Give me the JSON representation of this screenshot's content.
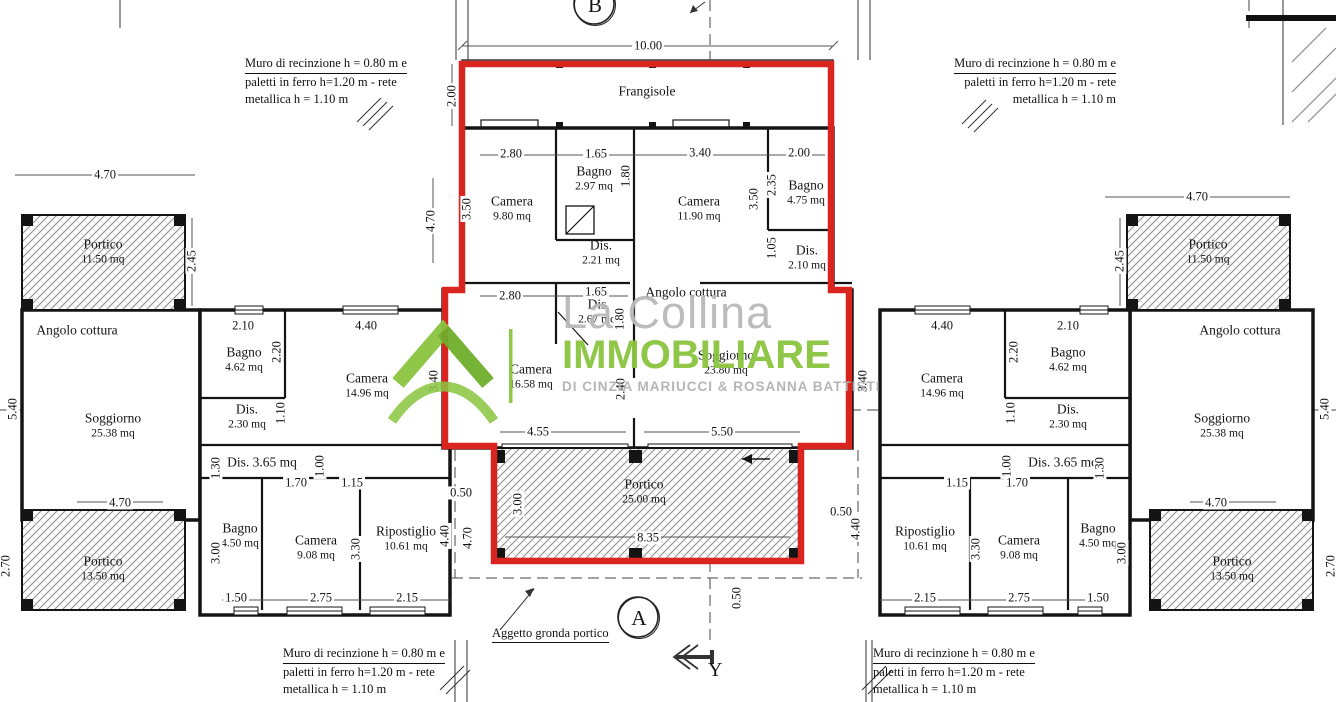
{
  "watermark": {
    "line1": "La Collina",
    "line2": "IMMOBILIARE",
    "line3": "DI CINZIA MARIUCCI & ROSANNA BATTISTI"
  },
  "markers": {
    "section_b": "B",
    "section_a": "A",
    "axis_y": "Y"
  },
  "callout_aggetto": "Aggetto gronda portico",
  "fence_note": {
    "line1": "Muro di recinzione h = 0.80 m e",
    "line2": "paletti in ferro h=1.20 m - rete",
    "line3": "metallica h = 1.10 m"
  },
  "colors": {
    "highlight_red": "#da2420",
    "brand_green": "#8bc53f",
    "hatch_gray": "#8f8f8f"
  },
  "rooms": [
    {
      "name": "Portico",
      "area": "11.50 mq",
      "x": 103,
      "y": 252
    },
    {
      "name": "Angolo cottura",
      "area": "",
      "x": 77,
      "y": 331
    },
    {
      "name": "Soggiorno",
      "area": "25.38 mq",
      "x": 113,
      "y": 426
    },
    {
      "name": "Bagno",
      "area": "4.62 mq",
      "x": 244,
      "y": 360
    },
    {
      "name": "Camera",
      "area": "14.96 mq",
      "x": 367,
      "y": 386
    },
    {
      "name": "Dis.",
      "area": "2.30 mq",
      "x": 247,
      "y": 417
    },
    {
      "name": "Dis.  3.65 mq",
      "area": "",
      "x": 262,
      "y": 463
    },
    {
      "name": "Bagno",
      "area": "4.50 mq",
      "x": 240,
      "y": 536
    },
    {
      "name": "Camera",
      "area": "9.08 mq",
      "x": 316,
      "y": 548
    },
    {
      "name": "Ripostiglio",
      "area": "10.61 mq",
      "x": 406,
      "y": 539
    },
    {
      "name": "Portico",
      "area": "13.50 mq",
      "x": 103,
      "y": 569
    },
    {
      "name": "Frangisole",
      "area": "",
      "x": 647,
      "y": 92
    },
    {
      "name": "Camera",
      "area": "9.80 mq",
      "x": 512,
      "y": 209
    },
    {
      "name": "Bagno",
      "area": "2.97 mq",
      "x": 594,
      "y": 179
    },
    {
      "name": "Camera",
      "area": "11.90 mq",
      "x": 699,
      "y": 209
    },
    {
      "name": "Bagno",
      "area": "4.75 mq",
      "x": 806,
      "y": 193
    },
    {
      "name": "Dis.",
      "area": "2.21 mq",
      "x": 601,
      "y": 253
    },
    {
      "name": "Dis.",
      "area": "2.10 mq",
      "x": 807,
      "y": 258
    },
    {
      "name": "Angolo cottura",
      "area": "",
      "x": 686,
      "y": 293
    },
    {
      "name": "Dis",
      "area": "2.67 mq",
      "x": 597,
      "y": 312
    },
    {
      "name": "Camera",
      "area": "16.58 mq",
      "x": 531,
      "y": 377
    },
    {
      "name": "Soggiorno",
      "area": "23.80 mq",
      "x": 726,
      "y": 363
    },
    {
      "name": "Portico",
      "area": "25.00 mq",
      "x": 644,
      "y": 492
    },
    {
      "name": "Portico",
      "area": "11.50 mq",
      "x": 1208,
      "y": 252
    },
    {
      "name": "Angolo cottura",
      "area": "",
      "x": 1240,
      "y": 331
    },
    {
      "name": "Soggiorno",
      "area": "25.38 mq",
      "x": 1222,
      "y": 426
    },
    {
      "name": "Bagno",
      "area": "4.62 mq",
      "x": 1068,
      "y": 360
    },
    {
      "name": "Camera",
      "area": "14.96 mq",
      "x": 942,
      "y": 386
    },
    {
      "name": "Dis.",
      "area": "2.30 mq",
      "x": 1068,
      "y": 417
    },
    {
      "name": "Dis.  3.65 mq",
      "area": "",
      "x": 1063,
      "y": 463
    },
    {
      "name": "Bagno",
      "area": "4.50 mq",
      "x": 1098,
      "y": 536
    },
    {
      "name": "Camera",
      "area": "9.08 mq",
      "x": 1019,
      "y": 548
    },
    {
      "name": "Ripostiglio",
      "area": "10.61 mq",
      "x": 925,
      "y": 539
    },
    {
      "name": "Portico",
      "area": "13.50 mq",
      "x": 1232,
      "y": 569
    }
  ],
  "dimensions": [
    {
      "v": "4.70",
      "x": 105,
      "y": 175
    },
    {
      "v": "2.45",
      "x": 192,
      "y": 261,
      "rot": true
    },
    {
      "v": "5.40",
      "x": 13,
      "y": 409,
      "rot": true
    },
    {
      "v": "2.70",
      "x": 6,
      "y": 566,
      "rot": true
    },
    {
      "v": "2.10",
      "x": 243,
      "y": 326
    },
    {
      "v": "4.40",
      "x": 366,
      "y": 326
    },
    {
      "v": "2.20",
      "x": 277,
      "y": 352,
      "rot": true
    },
    {
      "v": "3.40",
      "x": 434,
      "y": 381,
      "rot": true
    },
    {
      "v": "1.10",
      "x": 281,
      "y": 413,
      "rot": true
    },
    {
      "v": "1.30",
      "x": 216,
      "y": 468,
      "rot": true
    },
    {
      "v": "1.00",
      "x": 320,
      "y": 466,
      "rot": true
    },
    {
      "v": "1.70",
      "x": 296,
      "y": 483
    },
    {
      "v": "1.15",
      "x": 352,
      "y": 483
    },
    {
      "v": "3.00",
      "x": 216,
      "y": 553,
      "rot": true
    },
    {
      "v": "3.30",
      "x": 356,
      "y": 549,
      "rot": true
    },
    {
      "v": "4.40",
      "x": 445,
      "y": 536,
      "rot": true
    },
    {
      "v": "1.50",
      "x": 236,
      "y": 598
    },
    {
      "v": "2.75",
      "x": 321,
      "y": 598
    },
    {
      "v": "2.15",
      "x": 407,
      "y": 598
    },
    {
      "v": "4.70",
      "x": 120,
      "y": 503
    },
    {
      "v": "10.00",
      "x": 648,
      "y": 46
    },
    {
      "v": "2.00",
      "x": 452,
      "y": 96,
      "rot": true
    },
    {
      "v": "4.70",
      "x": 431,
      "y": 221,
      "rot": true
    },
    {
      "v": "2.80",
      "x": 511,
      "y": 154
    },
    {
      "v": "1.65",
      "x": 596,
      "y": 154
    },
    {
      "v": "3.40",
      "x": 700,
      "y": 153
    },
    {
      "v": "2.00",
      "x": 799,
      "y": 153
    },
    {
      "v": "3.50",
      "x": 467,
      "y": 209,
      "rot": true
    },
    {
      "v": "1.80",
      "x": 626,
      "y": 176,
      "rot": true
    },
    {
      "v": "3.50",
      "x": 754,
      "y": 199,
      "rot": true
    },
    {
      "v": "2.35",
      "x": 772,
      "y": 185,
      "rot": true
    },
    {
      "v": "1.05",
      "x": 772,
      "y": 248,
      "rot": true
    },
    {
      "v": "2.80",
      "x": 510,
      "y": 296
    },
    {
      "v": "1.65",
      "x": 596,
      "y": 292
    },
    {
      "v": "1.80",
      "x": 620,
      "y": 319,
      "rot": true
    },
    {
      "v": "2.40",
      "x": 621,
      "y": 389,
      "rot": true
    },
    {
      "v": "4.55",
      "x": 538,
      "y": 432
    },
    {
      "v": "5.50",
      "x": 722,
      "y": 432
    },
    {
      "v": "0.50",
      "x": 461,
      "y": 493
    },
    {
      "v": "4.70",
      "x": 468,
      "y": 538,
      "rot": true
    },
    {
      "v": "3.00",
      "x": 518,
      "y": 504,
      "rot": true
    },
    {
      "v": "8.35",
      "x": 648,
      "y": 538
    },
    {
      "v": "0.50",
      "x": 841,
      "y": 512
    },
    {
      "v": "4.40",
      "x": 856,
      "y": 529,
      "rot": true
    },
    {
      "v": "0.50",
      "x": 737,
      "y": 598,
      "rot": true
    },
    {
      "v": "4.70",
      "x": 1197,
      "y": 197
    },
    {
      "v": "2.45",
      "x": 1120,
      "y": 261,
      "rot": true
    },
    {
      "v": "5.40",
      "x": 1325,
      "y": 409,
      "rot": true
    },
    {
      "v": "2.70",
      "x": 1331,
      "y": 566,
      "rot": true
    },
    {
      "v": "4.40",
      "x": 942,
      "y": 326
    },
    {
      "v": "2.10",
      "x": 1068,
      "y": 326
    },
    {
      "v": "2.20",
      "x": 1014,
      "y": 352,
      "rot": true
    },
    {
      "v": "3.40",
      "x": 863,
      "y": 381,
      "rot": true
    },
    {
      "v": "1.10",
      "x": 1011,
      "y": 413,
      "rot": true
    },
    {
      "v": "1.30",
      "x": 1100,
      "y": 468,
      "rot": true
    },
    {
      "v": "1.00",
      "x": 1007,
      "y": 466,
      "rot": true
    },
    {
      "v": "1.15",
      "x": 957,
      "y": 483
    },
    {
      "v": "1.70",
      "x": 1017,
      "y": 483
    },
    {
      "v": "3.00",
      "x": 1122,
      "y": 553,
      "rot": true
    },
    {
      "v": "3.30",
      "x": 976,
      "y": 549,
      "rot": true
    },
    {
      "v": "2.15",
      "x": 925,
      "y": 598
    },
    {
      "v": "2.75",
      "x": 1019,
      "y": 598
    },
    {
      "v": "1.50",
      "x": 1098,
      "y": 598
    },
    {
      "v": "4.70",
      "x": 1216,
      "y": 503
    }
  ]
}
